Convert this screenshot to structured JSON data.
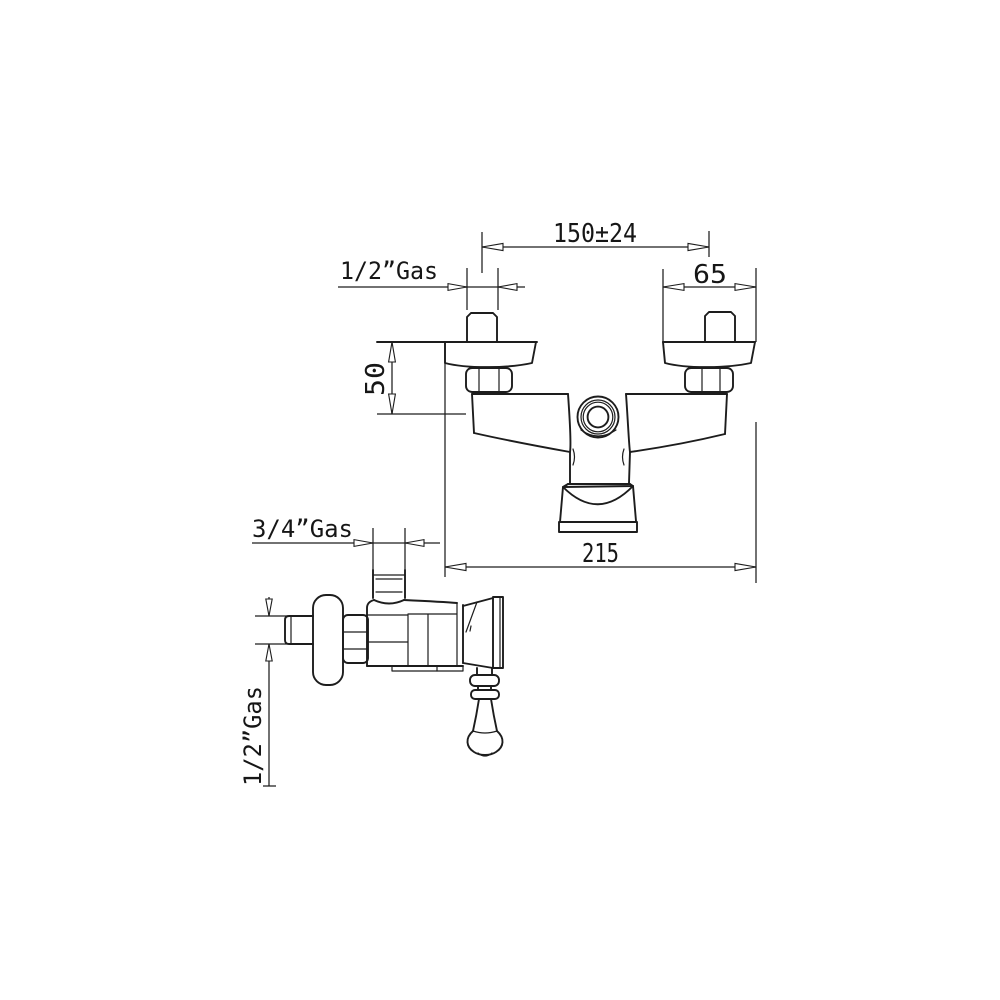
{
  "drawing": {
    "background_color": "#ffffff",
    "line_color": "#1d1d1d",
    "front_view": {
      "dim_center_distance": "150±24",
      "dim_flange_width": "65",
      "dim_top_inlet_thread": "1/2”Gas",
      "dim_wall_depth": "50",
      "dim_overall_width": "215"
    },
    "side_view": {
      "dim_outlet_thread": "3/4”Gas",
      "dim_inlet_thread": "1/2”Gas"
    }
  }
}
